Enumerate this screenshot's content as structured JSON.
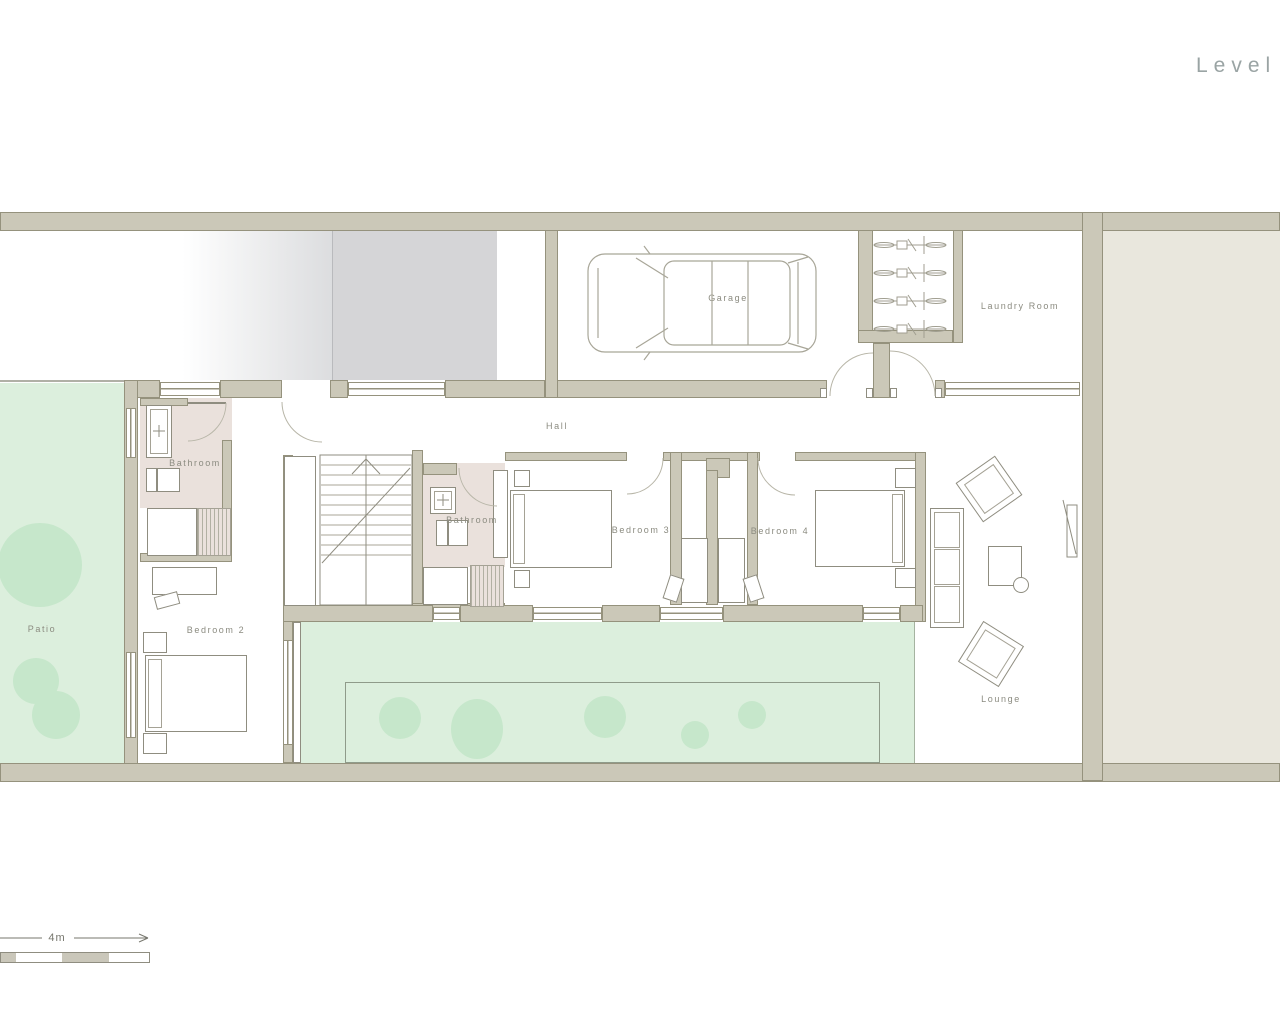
{
  "title": "Level /",
  "scale_bar": {
    "label": "4m"
  },
  "rooms": {
    "garage": {
      "label": "Garage"
    },
    "laundry_room": {
      "label": "Laundry Room"
    },
    "hall": {
      "label": "Hall"
    },
    "bathroom_1": {
      "label": "Bathroom"
    },
    "bathroom_2": {
      "label": "Bathroom"
    },
    "bedroom_2": {
      "label": "Bedroom 2"
    },
    "bedroom_3": {
      "label": "Bedroom 3"
    },
    "bedroom_4": {
      "label": "Bedroom 4"
    },
    "patio": {
      "label": "Patio"
    },
    "lounge": {
      "label": "Lounge"
    }
  },
  "colors": {
    "wall_fill": "#cbc8b8",
    "wall_outline": "#95927d",
    "patio_green": "#dcefdd",
    "bush_green": "#c6e7cb",
    "bathroom_floor": "#eae1dc",
    "neighbor_area": "#e9e7dd",
    "driveway_gray": "#d5d5d7",
    "linework": "#a09e90",
    "label_text": "#8b8b80",
    "title_text": "#9aa4a4"
  }
}
